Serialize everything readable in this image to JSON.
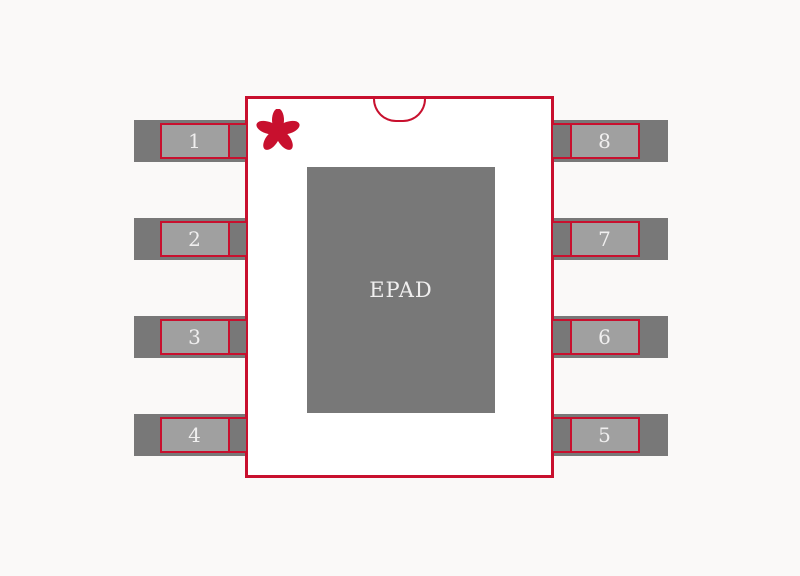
{
  "footprint": {
    "epad_label": "EPAD",
    "left_pins": [
      "1",
      "2",
      "3",
      "4"
    ],
    "right_pins": [
      "8",
      "7",
      "6",
      "5"
    ],
    "icons": {
      "pin1_marker": "asterisk-icon",
      "orientation_notch": "semicircle-notch-icon"
    },
    "colors": {
      "outline_red": "#C8102E",
      "pad_dark_gray": "#787878",
      "pad_light_gray": "#A0A0A0",
      "body_fill": "#FFFFFF",
      "background": "#FAF9F8",
      "pin_text": "#F0EFEF"
    }
  }
}
